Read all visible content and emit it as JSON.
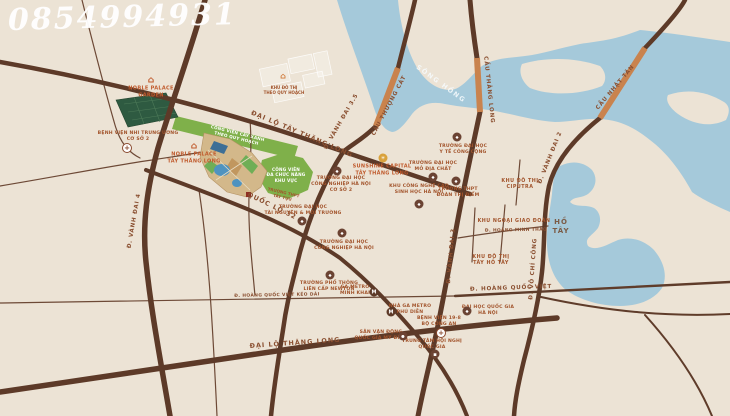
{
  "watermark": "0854994931",
  "colors": {
    "background": "#ece3d5",
    "road": "#5d3a28",
    "water": "#a5c9da",
    "park_green": "#7fb04a",
    "bridge": "#c9834e",
    "accent_orange": "#c05a2c"
  },
  "map": {
    "labels": [
      {
        "name": "road-label-dai-lo-tay-thang-long",
        "cls": "road-big",
        "text": "ĐẠI LỘ TÂY THĂNG LONG",
        "x": 302,
        "y": 134,
        "rot": 23
      },
      {
        "name": "road-label-vanh-dai-3-5",
        "cls": "road",
        "text": "Đ. VÀNH ĐAI 3.5",
        "x": 342,
        "y": 122,
        "rot": -60
      },
      {
        "name": "bridge-label-cau-thuong-cat",
        "cls": "road",
        "text": "CẦU THƯỢNG CÁT",
        "x": 390,
        "y": 106,
        "rot": -62
      },
      {
        "name": "river-label-song-hong",
        "cls": "water",
        "text": "SÔNG HỒNG",
        "x": 441,
        "y": 84,
        "rot": 36
      },
      {
        "name": "bridge-label-cau-thang-long",
        "cls": "road",
        "text": "CẦU THĂNG LONG",
        "x": 488,
        "y": 90,
        "rot": 84
      },
      {
        "name": "bridge-label-cau-nhat-tan",
        "cls": "road",
        "text": "CẦU NHẬT TÂN",
        "x": 616,
        "y": 88,
        "rot": -50
      },
      {
        "name": "road-label-vanh-dai-2",
        "cls": "road",
        "text": "Đ. VÀNH ĐAI 2",
        "x": 551,
        "y": 158,
        "rot": -68
      },
      {
        "name": "road-label-vanh-dai-4",
        "cls": "road",
        "text": "Đ. VÀNH ĐAI 4",
        "x": 135,
        "y": 221,
        "rot": -80
      },
      {
        "name": "road-label-quoc-lo-32",
        "cls": "road-big",
        "text": "QUỐC LỘ 32",
        "x": 272,
        "y": 206,
        "rot": 26
      },
      {
        "name": "road-label-vanh-dai-3",
        "cls": "road",
        "text": "Đ. VÀNH ĐAI 3",
        "x": 452,
        "y": 256,
        "rot": -85
      },
      {
        "name": "road-label-vo-chi-cong",
        "cls": "road",
        "text": "Đ. VÕ CHÍ CÔNG",
        "x": 534,
        "y": 269,
        "rot": -86
      },
      {
        "name": "road-label-hoang-quoc-viet-keo-dai",
        "cls": "road-sm",
        "text": "Đ. HOÀNG QUỐC VIỆT KÉO DÀI",
        "x": 277,
        "y": 296,
        "rot": -1
      },
      {
        "name": "road-label-hoang-quoc-viet",
        "cls": "road",
        "text": "Đ. HOÀNG QUỐC VIỆT",
        "x": 511,
        "y": 289,
        "rot": -2
      },
      {
        "name": "road-label-dai-lo-thang-long",
        "cls": "road-big",
        "text": "ĐẠI LỘ THĂNG LONG",
        "x": 295,
        "y": 343,
        "rot": -4
      },
      {
        "name": "road-label-hoang-minh-thao",
        "cls": "road-sm",
        "text": "Đ. HOÀNG MINH THẢO",
        "x": 516,
        "y": 231,
        "rot": -1
      },
      {
        "name": "lake-label-ho-tay",
        "cls": "lake",
        "text": "HỒ\nTÂY",
        "x": 561,
        "y": 227,
        "rot": 0
      },
      {
        "name": "area-label-ciputra",
        "cls": "area",
        "text": "KHU ĐÔ THỊ\nCIPUTRA",
        "x": 520,
        "y": 185,
        "rot": 0
      },
      {
        "name": "area-label-ngoai-giao-doan",
        "cls": "area",
        "text": "KHU NGOẠI GIAO ĐOÀN",
        "x": 514,
        "y": 222,
        "rot": 0
      },
      {
        "name": "area-label-tay-ho-tay",
        "cls": "area",
        "text": "KHU ĐÔ THỊ\nTÂY HỒ TÂY",
        "x": 491,
        "y": 261,
        "rot": 0
      },
      {
        "name": "park-label-cong-vien-da-chuc-nang",
        "cls": "park",
        "text": "CÔNG VIÊN\nĐA CHỨC NĂNG\nKHU VỰC",
        "x": 286,
        "y": 175,
        "rot": 0
      },
      {
        "name": "park-label-cong-vien-strip",
        "cls": "park",
        "text": "CÔNG VIÊN CÂY XANH\nTHEO QUY HOẠCH",
        "x": 237,
        "y": 136,
        "rot": 14
      },
      {
        "name": "project-label-noble-palace-garden",
        "cls": "project",
        "text": "NOBLE PALACE\nGARDEN",
        "x": 151,
        "y": 92,
        "rot": 0
      },
      {
        "name": "project-label-noble-palace-tay-thang-long",
        "cls": "project",
        "text": "NOBLE PALACE\nTÂY THĂNG LONG",
        "x": 194,
        "y": 158,
        "rot": 0
      },
      {
        "name": "project-label-sunshine-capital",
        "cls": "project",
        "text": "SUNSHINE CAPITAL\nTÂY THĂNG LONG",
        "x": 382,
        "y": 170,
        "rot": 0
      },
      {
        "name": "poi-label-benh-vien-nhi",
        "cls": "poi",
        "text": "BỆNH VIỆN NHI TRUNG ƯƠNG\nCƠ SỞ 2",
        "x": 138,
        "y": 137,
        "rot": 0
      },
      {
        "name": "poi-label-dh-cong-nghiep-cs2",
        "cls": "poi",
        "text": "TRƯỜNG ĐẠI HỌC\nCÔNG NGHIỆP HÀ NỘI\nCƠ SỞ 2",
        "x": 341,
        "y": 185,
        "rot": 0
      },
      {
        "name": "poi-label-dh-tai-nguyen-moi-truong",
        "cls": "poi",
        "text": "TRƯỜNG ĐẠI HỌC\nTÀI NGUYÊN & MÔI TRƯỜNG",
        "x": 303,
        "y": 211,
        "rot": 0
      },
      {
        "name": "poi-label-dh-cong-nghiep",
        "cls": "poi",
        "text": "TRƯỜNG ĐẠI HỌC\nCÔNG NGHIỆP HÀ NỘI",
        "x": 344,
        "y": 246,
        "rot": 0
      },
      {
        "name": "poi-label-truong-newton",
        "cls": "poi",
        "text": "TRƯỜNG PHỔ THÔNG\nLIÊN CẤP NEWTON",
        "x": 329,
        "y": 287,
        "rot": 0
      },
      {
        "name": "poi-label-ga-metro-minh-khai",
        "cls": "poi",
        "text": "GA METRO\nMINH KHAI",
        "x": 355,
        "y": 291,
        "rot": 0
      },
      {
        "name": "poi-label-ga-metro-phu-dien",
        "cls": "poi",
        "text": "NHÀ GA METRO\nPHÚ DIỄN",
        "x": 410,
        "y": 310,
        "rot": 0
      },
      {
        "name": "poi-label-benh-vien-19-8",
        "cls": "poi",
        "text": "BỆNH VIỆN 19-8\nBỘ CÔNG AN",
        "x": 439,
        "y": 322,
        "rot": 0
      },
      {
        "name": "poi-label-san-van-dong-my-dinh",
        "cls": "poi",
        "text": "SÂN VẬN ĐỘNG\nQUỐC GIA MỸ ĐÌNH",
        "x": 381,
        "y": 336,
        "rot": 0
      },
      {
        "name": "poi-label-trung-tam-hoi-nghi",
        "cls": "poi",
        "text": "TRUNG TÂM HỘI NGHỊ\nQUỐC GIA",
        "x": 432,
        "y": 345,
        "rot": 0
      },
      {
        "name": "poi-label-dai-hoc-quoc-gia",
        "cls": "poi",
        "text": "ĐẠI HỌC QUỐC GIA\nHÀ NỘI",
        "x": 488,
        "y": 311,
        "rot": 0
      },
      {
        "name": "poi-label-dh-y-te-cong-cong",
        "cls": "poi",
        "text": "TRƯỜNG ĐẠI HỌC\nY TẾ CÔNG CỘNG",
        "x": 463,
        "y": 150,
        "rot": 0
      },
      {
        "name": "poi-label-dh-mo-dia-chat",
        "cls": "poi",
        "text": "TRƯỜNG ĐẠI HỌC\nMỎ ĐỊA CHẤT",
        "x": 433,
        "y": 167,
        "rot": 0
      },
      {
        "name": "poi-label-khu-cong-nghe-cao",
        "cls": "poi",
        "text": "KHU CÔNG NGHỆ CAO\nSINH HỌC HÀ NỘI",
        "x": 419,
        "y": 190,
        "rot": 0
      },
      {
        "name": "poi-label-thpt-doan-thi-diem",
        "cls": "poi",
        "text": "TRƯỜNG THPT\nĐOÀN THỊ ĐIỂM",
        "x": 458,
        "y": 193,
        "rot": 0
      },
      {
        "name": "poi-label-khu-do-thi-quy-hoach",
        "cls": "poi-sm",
        "text": "KHU ĐÔ THỊ\nTHEO QUY HOẠCH",
        "x": 284,
        "y": 90,
        "rot": 0
      },
      {
        "name": "poi-label-truong-tay-tuu",
        "cls": "poi-sm",
        "text": "TRƯỜNG THPT\nTÂY TỰU",
        "x": 283,
        "y": 195,
        "rot": 13
      }
    ],
    "icons": [
      {
        "name": "building-icon-noble-palace-garden",
        "kind": "building",
        "x": 151,
        "y": 80
      },
      {
        "name": "building-icon-noble-palace-ttl",
        "kind": "building",
        "x": 194,
        "y": 146
      },
      {
        "name": "sun-icon-sunshine-capital",
        "kind": "sun",
        "x": 383,
        "y": 158
      },
      {
        "name": "hospital-icon-benh-vien-nhi",
        "kind": "hospital",
        "x": 127,
        "y": 148
      },
      {
        "name": "school-icon-dh-cong-nghiep-cs2",
        "kind": "school",
        "x": 337,
        "y": 171
      },
      {
        "name": "school-icon-dh-tai-nguyen",
        "kind": "school",
        "x": 302,
        "y": 221
      },
      {
        "name": "school-icon-dh-cong-nghiep",
        "kind": "school",
        "x": 342,
        "y": 233
      },
      {
        "name": "school-icon-truong-newton",
        "kind": "school",
        "x": 330,
        "y": 275
      },
      {
        "name": "metro-icon-minh-khai",
        "kind": "metro",
        "x": 374,
        "y": 292
      },
      {
        "name": "metro-icon-phu-dien",
        "kind": "metro",
        "x": 391,
        "y": 312
      },
      {
        "name": "hospital-icon-benh-vien-19-8",
        "kind": "hospital",
        "x": 441,
        "y": 333
      },
      {
        "name": "stadium-icon-my-dinh",
        "kind": "stadium",
        "x": 403,
        "y": 336
      },
      {
        "name": "conference-icon-hoi-nghi-quoc-gia",
        "kind": "conference",
        "x": 435,
        "y": 354
      },
      {
        "name": "school-icon-dai-hoc-quoc-gia",
        "kind": "school",
        "x": 467,
        "y": 311
      },
      {
        "name": "school-icon-dh-y-te-cong-cong",
        "kind": "school",
        "x": 457,
        "y": 137
      },
      {
        "name": "school-icon-dh-mo-dia-chat",
        "kind": "school",
        "x": 433,
        "y": 177
      },
      {
        "name": "tech-icon-khu-cong-nghe-cao",
        "kind": "tech",
        "x": 419,
        "y": 204
      },
      {
        "name": "school-icon-thpt-doan-thi-diem",
        "kind": "school",
        "x": 456,
        "y": 181
      },
      {
        "name": "building-icon-khu-do-thi-quy-hoach",
        "kind": "building-faint",
        "x": 283,
        "y": 76
      }
    ]
  }
}
